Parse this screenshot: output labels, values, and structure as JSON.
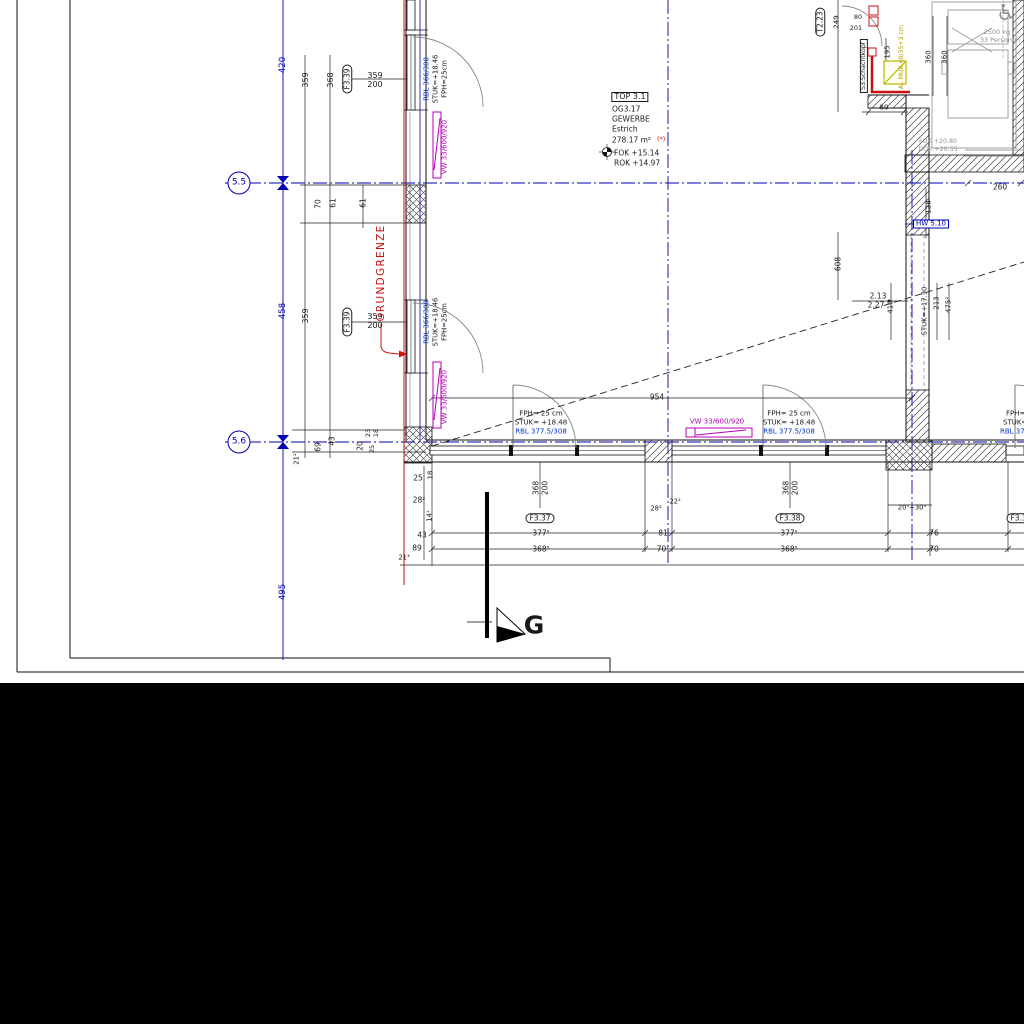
{
  "colors": {
    "black": "#1a1a1a",
    "blue": "#0000b2",
    "tblue": "#0033cc",
    "magenta": "#b400b4",
    "red": "#cc1111",
    "gray": "#909090",
    "yellow": "#b0a000"
  },
  "drawing": {
    "grid_axes": [
      "5.5",
      "5.6"
    ],
    "room": {
      "tag": "TOP 3.1",
      "number": "OG3.17",
      "use": "GEWERBE",
      "floor_finish": "Estrich",
      "area": "278.17 m²",
      "fok": "FOK +15.14",
      "rok": "ROK +14.97"
    },
    "boundary_label": "GRUNDGRENZE",
    "section_marker": "G",
    "lift": {
      "capacity": "2500 kg /",
      "persons": "33 Personen"
    }
  },
  "annotations": [
    {
      "name": "grid-bubble-5-5",
      "text": "5.5",
      "x": 239,
      "y": 183,
      "color": "blue",
      "size": 9,
      "box": "circle"
    },
    {
      "name": "grid-bubble-5-6",
      "text": "5.6",
      "x": 239,
      "y": 442,
      "color": "blue",
      "size": 9,
      "box": "circle"
    },
    {
      "name": "dim-420",
      "text": "420",
      "x": 283,
      "y": 65,
      "rot": -90,
      "color": "blue",
      "size": 8.5
    },
    {
      "name": "dim-458",
      "text": "458",
      "x": 283,
      "y": 311,
      "rot": -90,
      "color": "blue",
      "size": 8.5
    },
    {
      "name": "dim-495",
      "text": "495",
      "x": 283,
      "y": 592,
      "rot": -90,
      "color": "blue",
      "size": 8.5
    },
    {
      "name": "dim-359-top",
      "text": "359",
      "x": 306,
      "y": 80,
      "rot": -90
    },
    {
      "name": "dim-368-top",
      "text": "368",
      "x": 331,
      "y": 80,
      "rot": -90
    },
    {
      "name": "window-tag-f339-top",
      "text": "F3.39",
      "x": 347,
      "y": 79,
      "rot": -90,
      "size": 7.5,
      "box": "oval"
    },
    {
      "name": "window-dim-359-top",
      "text": "359",
      "x": 375,
      "y": 76
    },
    {
      "name": "window-dim-200-top",
      "text": "200",
      "x": 375,
      "y": 85
    },
    {
      "name": "rbl-window-top",
      "text": "RBL 366/308",
      "x": 427,
      "y": 79,
      "rot": -90,
      "color": "tblue",
      "size": 6.8
    },
    {
      "name": "stuk-window-top",
      "text": "STUK=+18.46",
      "x": 436,
      "y": 79,
      "rot": -90,
      "size": 6.8
    },
    {
      "name": "fph-window-top",
      "text": "FPH=25cm",
      "x": 445,
      "y": 79,
      "rot": -90,
      "size": 6.8
    },
    {
      "name": "vw-tag-top",
      "text": "VW 33/600/920",
      "x": 445,
      "y": 147,
      "rot": -90,
      "color": "magenta",
      "size": 7
    },
    {
      "name": "dim-70",
      "text": "70",
      "x": 318,
      "y": 204,
      "rot": -90,
      "size": 7.5
    },
    {
      "name": "dim-61-a",
      "text": "61",
      "x": 333,
      "y": 203,
      "rot": -90,
      "size": 7.5
    },
    {
      "name": "dim-61-b",
      "text": "61",
      "x": 363,
      "y": 203,
      "rot": -90,
      "size": 7.5
    },
    {
      "name": "grundgrenze-label",
      "text": "GRUNDGRENZE",
      "x": 381,
      "y": 273,
      "rot": -90,
      "color": "red",
      "size": 10.5,
      "ls": true
    },
    {
      "name": "dim-359-mid",
      "text": "359",
      "x": 306,
      "y": 316,
      "rot": -90
    },
    {
      "name": "window-tag-f339-mid",
      "text": "F3.39",
      "x": 347,
      "y": 322,
      "rot": -90,
      "size": 7.5,
      "box": "oval"
    },
    {
      "name": "window-dim-359-mid",
      "text": "359",
      "x": 375,
      "y": 317
    },
    {
      "name": "window-dim-200-mid",
      "text": "200",
      "x": 375,
      "y": 326
    },
    {
      "name": "rbl-window-mid",
      "text": "RBL 366/308",
      "x": 427,
      "y": 322,
      "rot": -90,
      "color": "tblue",
      "size": 6.8
    },
    {
      "name": "stuk-window-mid",
      "text": "STUK=+18.46",
      "x": 436,
      "y": 322,
      "rot": -90,
      "size": 6.8
    },
    {
      "name": "fph-window-mid",
      "text": "FPH=25cm",
      "x": 445,
      "y": 322,
      "rot": -90,
      "size": 6.8
    },
    {
      "name": "vw-tag-mid",
      "text": "VW 33/600/920",
      "x": 445,
      "y": 397,
      "rot": -90,
      "color": "magenta",
      "size": 7
    },
    {
      "name": "room-tag",
      "text": "TOP 3.1",
      "x": 630,
      "y": 97,
      "size": 8,
      "box": "rect"
    },
    {
      "name": "room-number",
      "text": "OG3.17",
      "x": 612,
      "y": 109,
      "align": "l",
      "size": 7.5
    },
    {
      "name": "room-use",
      "text": "GEWERBE",
      "x": 612,
      "y": 119,
      "align": "l",
      "size": 7.5
    },
    {
      "name": "room-floor-finish",
      "text": "Estrich",
      "x": 612,
      "y": 129,
      "align": "l",
      "size": 7.5
    },
    {
      "name": "room-area",
      "text": "278.17 m²",
      "x": 612,
      "y": 140,
      "align": "l",
      "size": 7.5
    },
    {
      "name": "room-area-note",
      "text": "(*)",
      "x": 657,
      "y": 139,
      "align": "l",
      "color": "red",
      "size": 6.5
    },
    {
      "name": "room-fok",
      "text": "FOK +15.14",
      "x": 614,
      "y": 153,
      "align": "l",
      "size": 7.5
    },
    {
      "name": "room-rok",
      "text": "ROK +14.97",
      "x": 614,
      "y": 163,
      "align": "l",
      "size": 7.5
    },
    {
      "name": "dim-21-2",
      "text": "21²",
      "x": 297,
      "y": 459,
      "rot": -90,
      "size": 6.8
    },
    {
      "name": "dim-69",
      "text": "69",
      "x": 318,
      "y": 447,
      "rot": -90,
      "size": 7.5
    },
    {
      "name": "dim-43-corner",
      "text": "43",
      "x": 332,
      "y": 441,
      "rot": -90,
      "size": 7.5
    },
    {
      "name": "dim-20",
      "text": "20",
      "x": 360,
      "y": 446,
      "rot": -90,
      "size": 7.5
    },
    {
      "name": "dim-23",
      "text": "23",
      "x": 368,
      "y": 433,
      "rot": -90,
      "size": 6.5
    },
    {
      "name": "dim-18-corner",
      "text": "18",
      "x": 376,
      "y": 433,
      "rot": -90,
      "size": 6.5
    },
    {
      "name": "dim-25-corner",
      "text": "25",
      "x": 372,
      "y": 449,
      "rot": -90,
      "size": 6.5
    },
    {
      "name": "dim-25",
      "text": "25",
      "x": 418,
      "y": 478,
      "size": 7.5
    },
    {
      "name": "dim-18",
      "text": "18",
      "x": 431,
      "y": 475,
      "rot": -90,
      "size": 6.8
    },
    {
      "name": "dim-28-2",
      "text": "28²",
      "x": 419,
      "y": 500,
      "size": 7.5
    },
    {
      "name": "dim-14-1",
      "text": "14¹",
      "x": 430,
      "y": 516,
      "rot": -90,
      "size": 6.8
    },
    {
      "name": "dim-43",
      "text": "43",
      "x": 422,
      "y": 535,
      "size": 7.5
    },
    {
      "name": "dim-89",
      "text": "89",
      "x": 417,
      "y": 548,
      "size": 7.5
    },
    {
      "name": "dim-21-3",
      "text": "21³",
      "x": 404,
      "y": 558,
      "size": 6.8
    },
    {
      "name": "fph-door-1",
      "text": "FPH= 25 cm",
      "x": 541,
      "y": 414,
      "size": 7
    },
    {
      "name": "stuk-door-1",
      "text": "STUK= +18.48",
      "x": 541,
      "y": 423,
      "size": 7
    },
    {
      "name": "rbl-door-1",
      "text": "RBL 377.5/308",
      "x": 541,
      "y": 432,
      "color": "tblue",
      "size": 7
    },
    {
      "name": "dim-368-door1",
      "text": "368",
      "x": 536,
      "y": 488,
      "rot": -90,
      "size": 7.5
    },
    {
      "name": "dim-200-door1",
      "text": "200",
      "x": 545,
      "y": 488,
      "rot": -90,
      "size": 7.5
    },
    {
      "name": "window-tag-f337",
      "text": "F3.37",
      "x": 540,
      "y": 518,
      "size": 7.5,
      "box": "oval"
    },
    {
      "name": "vw-tag-bottom",
      "text": "VW 33/600/920",
      "x": 717,
      "y": 422,
      "color": "magenta",
      "size": 7
    },
    {
      "name": "dim-954",
      "text": "954",
      "x": 657,
      "y": 397,
      "size": 7.5
    },
    {
      "name": "fph-door-2",
      "text": "FPH= 25 cm",
      "x": 789,
      "y": 414,
      "size": 7
    },
    {
      "name": "stuk-door-2",
      "text": "STUK= +18.48",
      "x": 789,
      "y": 423,
      "size": 7
    },
    {
      "name": "rbl-door-2",
      "text": "RBL 377.5/308",
      "x": 789,
      "y": 432,
      "color": "tblue",
      "size": 7
    },
    {
      "name": "dim-368-door2",
      "text": "368",
      "x": 786,
      "y": 488,
      "rot": -90,
      "size": 7.5
    },
    {
      "name": "dim-200-door2",
      "text": "200",
      "x": 795,
      "y": 488,
      "rot": -90,
      "size": 7.5
    },
    {
      "name": "window-tag-f338",
      "text": "F3.38",
      "x": 790,
      "y": 518,
      "size": 7.5,
      "box": "oval"
    },
    {
      "name": "dim-28-2-pier",
      "text": "28²",
      "x": 656,
      "y": 509,
      "size": 6.8
    },
    {
      "name": "dim-22-2-pier",
      "text": "22²",
      "x": 675,
      "y": 502,
      "size": 6.8
    },
    {
      "name": "dim-377-5-a",
      "text": "377⁵",
      "x": 541,
      "y": 533,
      "size": 7.5
    },
    {
      "name": "dim-81",
      "text": "81",
      "x": 663,
      "y": 533,
      "size": 7.5
    },
    {
      "name": "dim-377-5-b",
      "text": "377⁵",
      "x": 789,
      "y": 533,
      "size": 7.5
    },
    {
      "name": "dim-76",
      "text": "76",
      "x": 934,
      "y": 533,
      "size": 7.5
    },
    {
      "name": "dim-368-5-a",
      "text": "368⁵",
      "x": 541,
      "y": 549,
      "size": 7.5
    },
    {
      "name": "dim-70-1",
      "text": "70¹",
      "x": 663,
      "y": 549,
      "size": 7.5
    },
    {
      "name": "dim-368-5-b",
      "text": "368⁵",
      "x": 789,
      "y": 549,
      "size": 7.5
    },
    {
      "name": "dim-70-b",
      "text": "70",
      "x": 934,
      "y": 549,
      "size": 7.5
    },
    {
      "name": "dim-20-5-30-5",
      "text": "20⁵+30⁵",
      "x": 912,
      "y": 508,
      "size": 6.8
    },
    {
      "name": "dim-2-13",
      "text": "2.13",
      "x": 878,
      "y": 296,
      "size": 7.5
    },
    {
      "name": "dim-2-27",
      "text": "2.27",
      "x": 876,
      "y": 305,
      "size": 7.5
    },
    {
      "name": "dim-410",
      "text": "410",
      "x": 891,
      "y": 307,
      "rot": -90,
      "size": 7
    },
    {
      "name": "stuk-17-30",
      "text": "STUK=+17.30",
      "x": 925,
      "y": 311,
      "rot": -90,
      "size": 6.8
    },
    {
      "name": "dim-213",
      "text": "213",
      "x": 937,
      "y": 303,
      "rot": -90,
      "size": 7
    },
    {
      "name": "dim-475-2",
      "text": "475²",
      "x": 949,
      "y": 305,
      "rot": -90,
      "size": 7
    },
    {
      "name": "dim-608",
      "text": "608",
      "x": 838,
      "y": 264,
      "rot": -90,
      "size": 7.5
    },
    {
      "name": "dim-260",
      "text": "260",
      "x": 1000,
      "y": 187,
      "size": 7.5
    },
    {
      "name": "dim-128",
      "text": "128",
      "x": 929,
      "y": 207,
      "rot": -90,
      "size": 7
    },
    {
      "name": "hw-tag",
      "text": "HW 5.10",
      "x": 931,
      "y": 224,
      "color": "blue",
      "size": 7,
      "box": "rect"
    },
    {
      "name": "fok-20-80",
      "text": "FOK +20.80",
      "x": 938,
      "y": 142,
      "color": "gray",
      "size": 6.3
    },
    {
      "name": "dok-20-55",
      "text": "DOK +20.55",
      "x": 938,
      "y": 150,
      "color": "gray",
      "size": 6.3
    },
    {
      "name": "lift-capacity",
      "text": "2500 kg /",
      "x": 999,
      "y": 32,
      "color": "gray",
      "size": 6.5
    },
    {
      "name": "lift-persons",
      "text": "33 Personen",
      "x": 1000,
      "y": 40,
      "color": "gray",
      "size": 6.5
    },
    {
      "name": "wheelchair-icon",
      "text": "♿",
      "x": 1006,
      "y": 14,
      "color": "gray",
      "size": 22
    },
    {
      "name": "dim-360-a",
      "text": "360",
      "x": 929,
      "y": 57,
      "rot": -90,
      "size": 7
    },
    {
      "name": "dim-360-b",
      "text": "360",
      "x": 945,
      "y": 57,
      "rot": -90,
      "size": 7
    },
    {
      "name": "dim-195",
      "text": "195",
      "x": 888,
      "y": 52,
      "rot": -90,
      "size": 6.8
    },
    {
      "name": "al-muk-note",
      "text": "AL MUK 40/35+3 cm",
      "x": 902,
      "y": 57,
      "rot": -90,
      "color": "yellow",
      "size": 6.2
    },
    {
      "name": "schachtkopf-tag",
      "text": "S3.Schachtkopf",
      "x": 864,
      "y": 66,
      "rot": -90,
      "size": 6.2,
      "box": "rect"
    },
    {
      "name": "door-tag-t223",
      "text": "T2.23",
      "x": 820,
      "y": 22,
      "rot": -90,
      "size": 7.5,
      "box": "oval"
    },
    {
      "name": "dim-249",
      "text": "249",
      "x": 837,
      "y": 22,
      "rot": -90,
      "size": 7
    },
    {
      "name": "dim-80-top",
      "text": "80",
      "x": 858,
      "y": 17,
      "size": 6.5
    },
    {
      "name": "dim-201",
      "text": "201",
      "x": 856,
      "y": 28,
      "size": 6.5
    },
    {
      "name": "dim-80-shaft",
      "text": "80",
      "x": 884,
      "y": 108,
      "size": 7
    },
    {
      "name": "section-label-g",
      "text": "G",
      "x": 534,
      "y": 625,
      "size": 25,
      "bold": true
    },
    {
      "name": "fph-door-3",
      "text": "FPH= 25 cm",
      "x": 1006,
      "y": 414,
      "align": "l",
      "size": 7
    },
    {
      "name": "stuk-door-3",
      "text": "STUK= +18.48",
      "x": 1003,
      "y": 423,
      "align": "l",
      "size": 7
    },
    {
      "name": "rbl-door-3",
      "text": "RBL 377.5/308",
      "x": 1000,
      "y": 432,
      "align": "l",
      "color": "tblue",
      "size": 7
    },
    {
      "name": "window-tag-f339-right",
      "text": "F3.39",
      "x": 1021,
      "y": 518,
      "size": 7.5,
      "box": "oval"
    }
  ]
}
